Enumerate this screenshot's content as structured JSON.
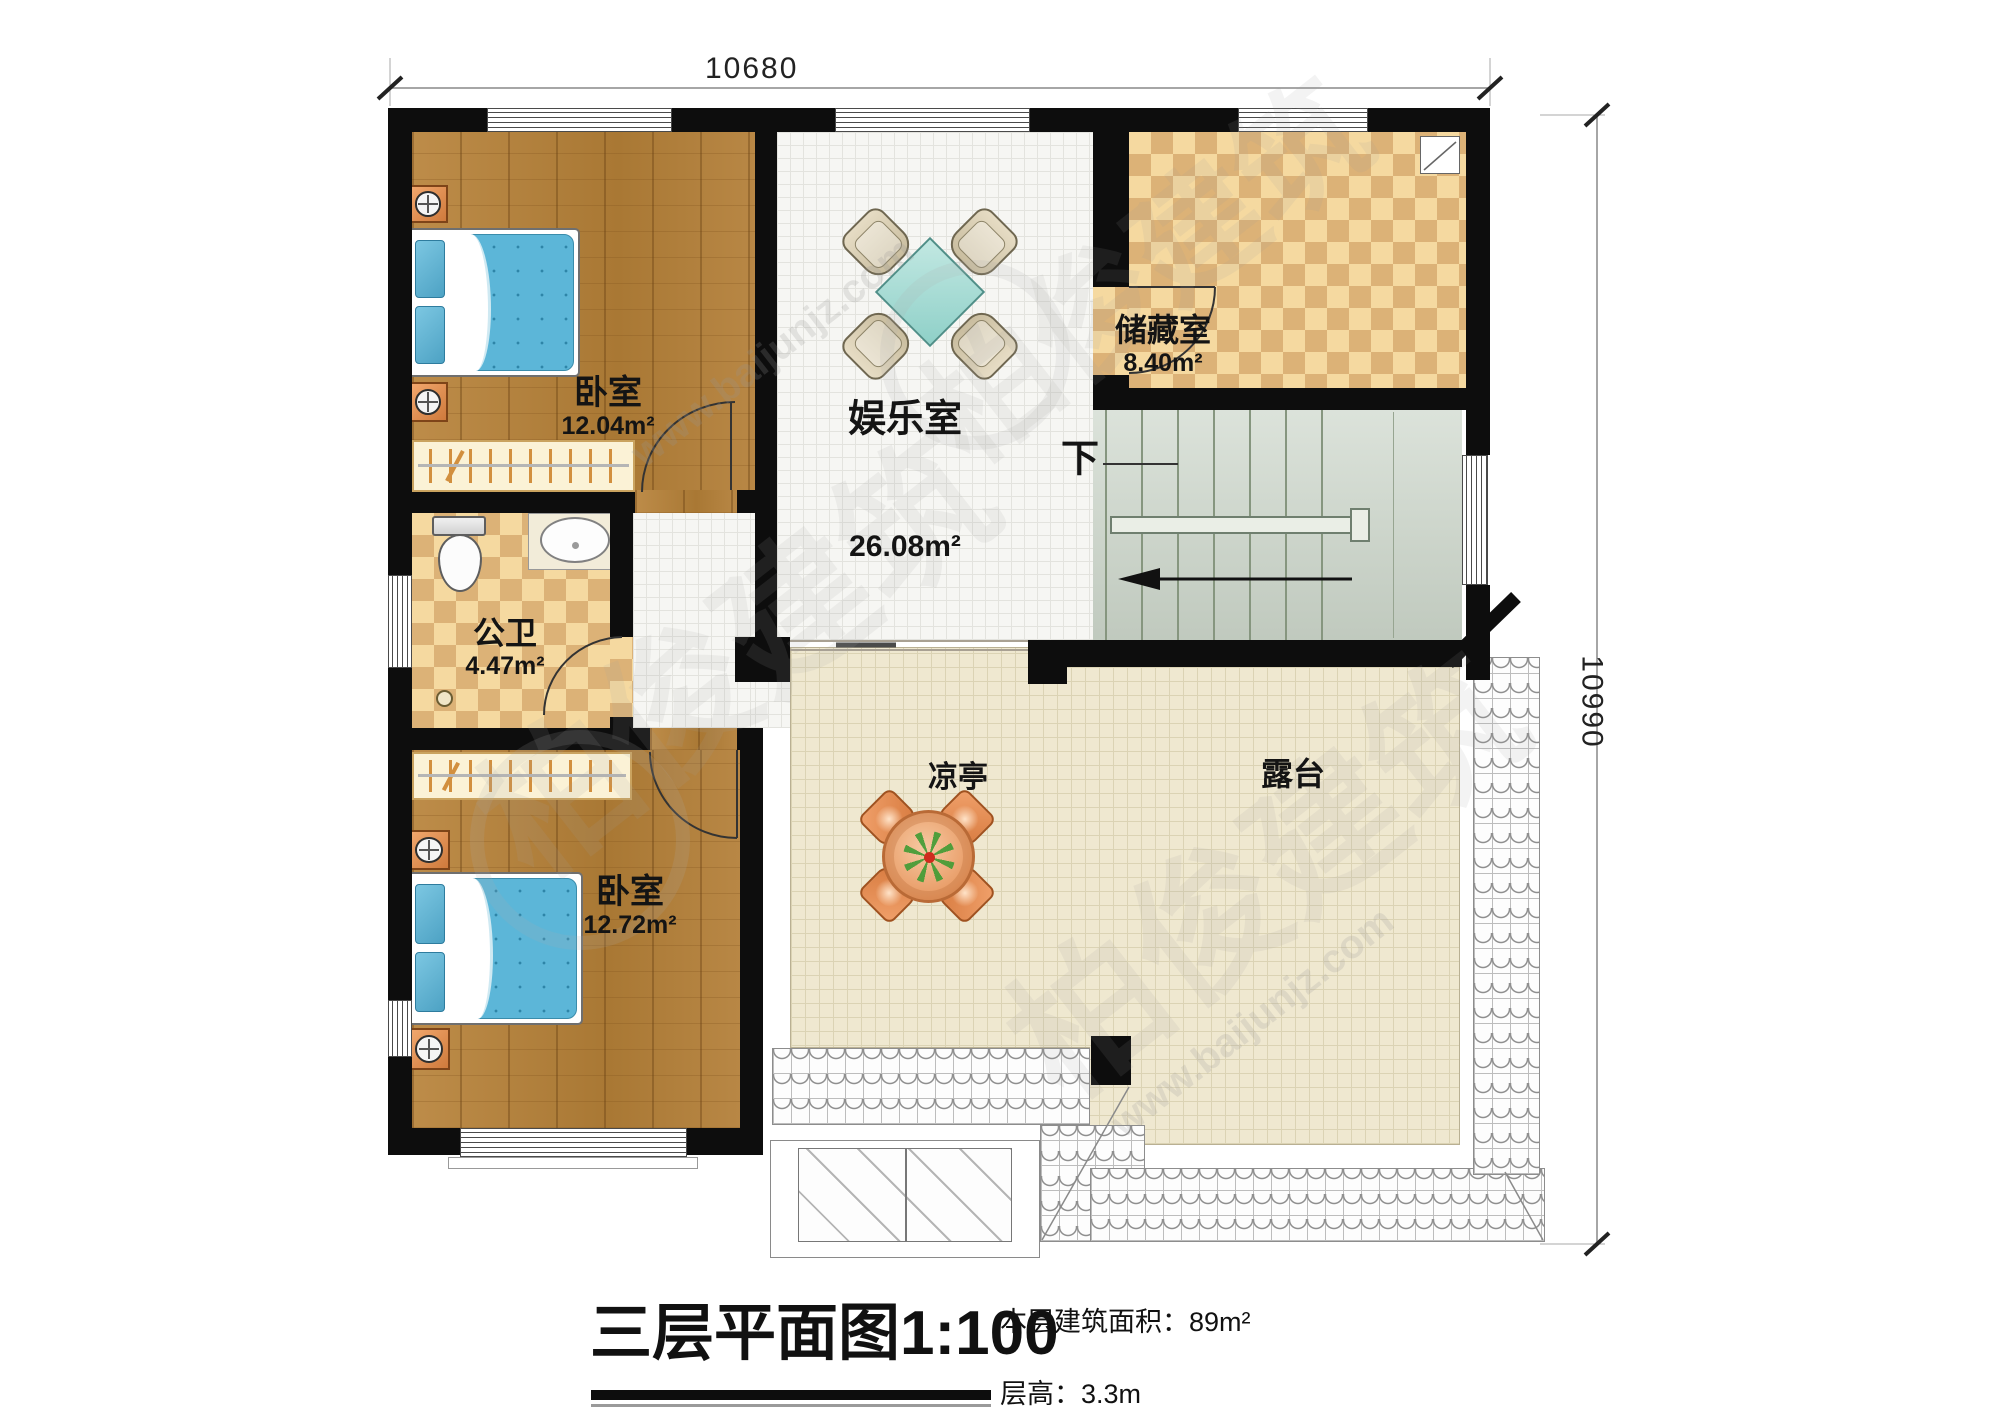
{
  "meta": {
    "drawing_type": "residential floor plan"
  },
  "dimensions": {
    "top_width": "10680",
    "right_height": "10990"
  },
  "rooms": {
    "bedroom_top": {
      "name": "卧室",
      "area": "12.04m²"
    },
    "bedroom_bottom": {
      "name": "卧室",
      "area": "12.72m²"
    },
    "bathroom": {
      "name": "公卫",
      "area": "4.47m²"
    },
    "entertainment": {
      "name": "娱乐室",
      "area": "26.08m²"
    },
    "storage": {
      "name": "储藏室",
      "area": "8.40m²"
    },
    "pavilion": {
      "name": "凉亭"
    },
    "terrace": {
      "name": "露台"
    }
  },
  "stairs": {
    "direction_label": "下"
  },
  "title_block": {
    "title": "三层平面图",
    "scale": "1:100",
    "floor_area_note": "本层建筑面积：89m²",
    "floor_height_note": "层高：3.3m"
  },
  "watermark": {
    "brand": "柏俊建筑",
    "website": "www.baijunjz.com"
  }
}
